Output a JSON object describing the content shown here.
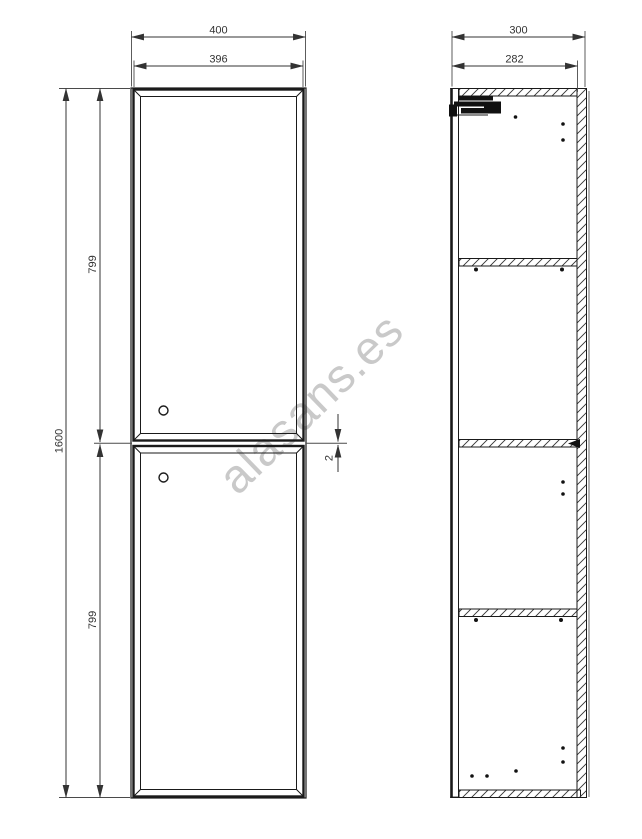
{
  "title": "tall cabinet technical drawing",
  "watermark": {
    "text": "alasans.es",
    "color": "#c9c9c9"
  },
  "front_view": {
    "label": "front view",
    "dims": {
      "overall_width": "400",
      "door_width": "396",
      "overall_height": "1600",
      "top_door_height": "799",
      "bottom_door_height": "799",
      "door_gap": "2"
    }
  },
  "side_view": {
    "label": "side section view",
    "dims": {
      "overall_depth": "300",
      "internal_depth": "282"
    }
  },
  "colors": {
    "line": "#1a1a1a",
    "dim_line": "#333333",
    "dim_text": "#333333",
    "watermark": "#c9c9c9"
  }
}
